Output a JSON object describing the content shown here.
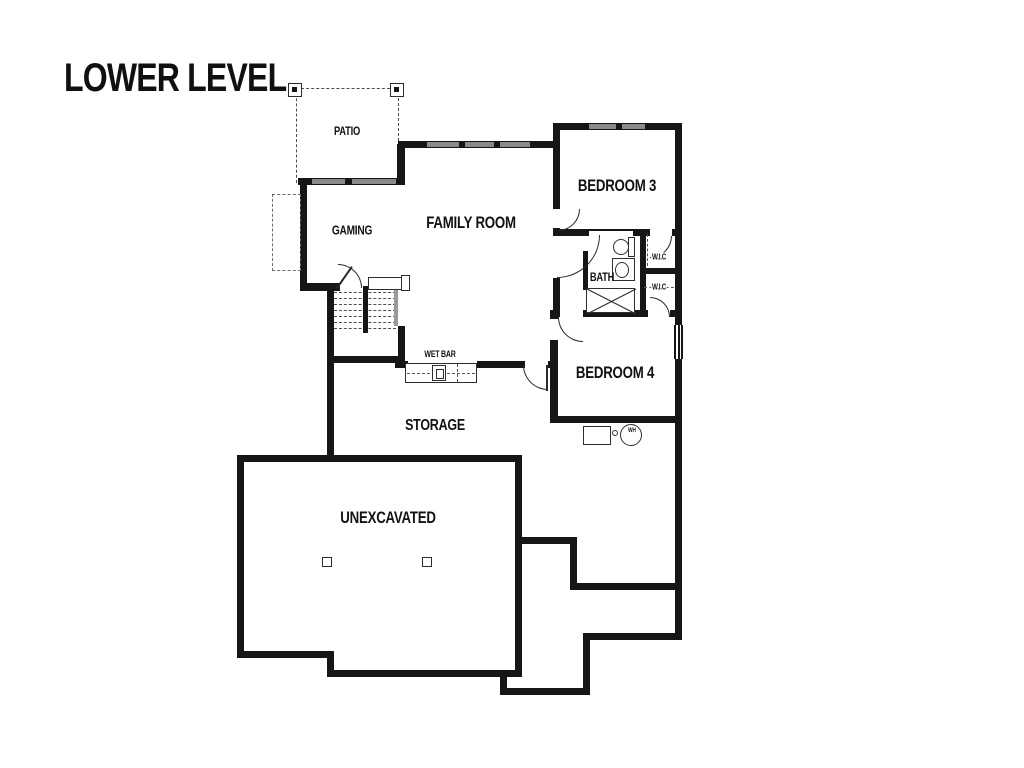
{
  "title": "LOWER LEVEL",
  "rooms": {
    "patio": "PATIO",
    "gaming": "GAMING",
    "family_room": "FAMILY ROOM",
    "bedroom3": "BEDROOM 3",
    "bath": "BATH",
    "wic_upper": "W.I.C",
    "wic_lower": "W.I.C",
    "bedroom4": "BEDROOM 4",
    "wet_bar": "WET BAR",
    "storage": "STORAGE",
    "unexcavated": "UNEXCAVATED"
  },
  "fixtures": {
    "water_heater_label": "WH"
  },
  "colors": {
    "wall": "#161616",
    "window_gray": "#8a8a8a",
    "background": "#ffffff"
  }
}
